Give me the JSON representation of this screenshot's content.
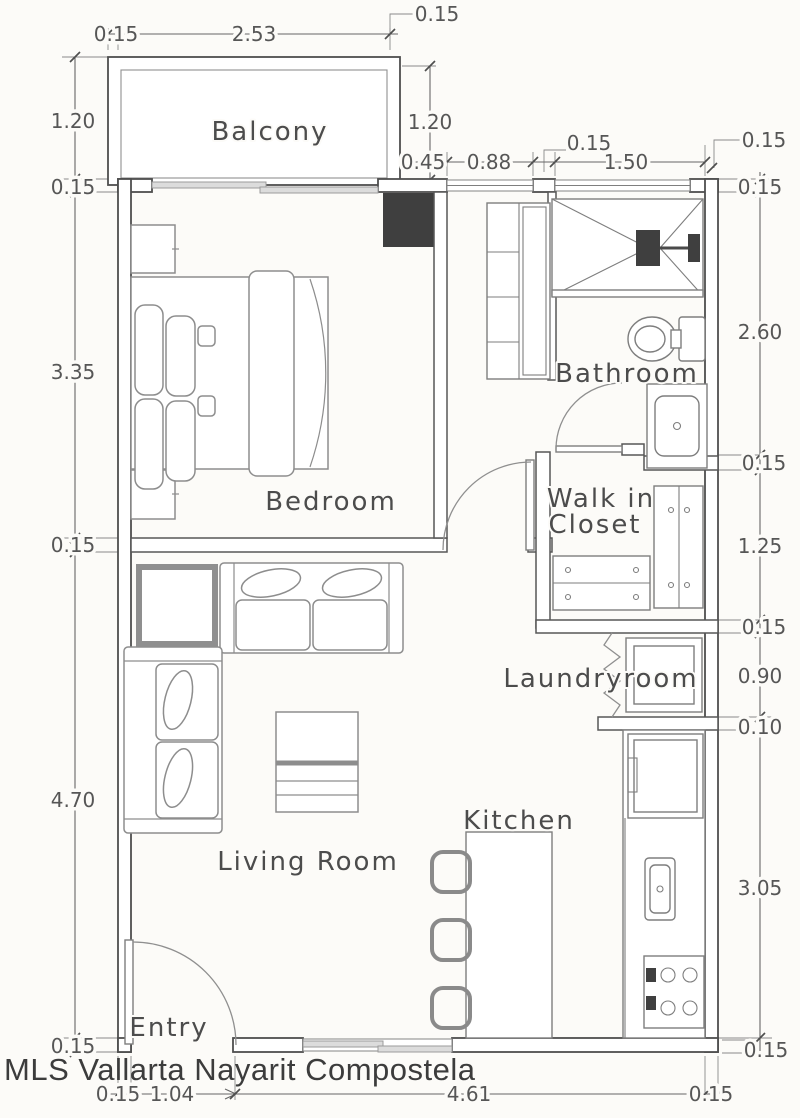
{
  "watermark": "MLS Vallarta Nayarit Compostela",
  "rooms": {
    "balcony": "Balcony",
    "bedroom": "Bedroom",
    "bathroom": "Bathroom",
    "walk_in_closet_line1": "Walk in",
    "walk_in_closet_line2": "Closet",
    "laundry": "Laundryroom",
    "living": "Living Room",
    "kitchen": "Kitchen",
    "entry": "Entry"
  },
  "dims": {
    "top_balcony_wall": "0.15",
    "top_balcony_width": "2.53",
    "top_leader": "0.15",
    "balcony_depth_left": "1.20",
    "balcony_depth_right": "1.20",
    "column_width": "0.45",
    "window_small": "0.88",
    "window_pier": "0.15",
    "window_large": "1.50",
    "right_wall_top": "0.15",
    "left_wall_top": "0.15",
    "bedroom_width": "3.35",
    "divider_wall": "0.15",
    "living_width": "4.70",
    "left_bottom_wall": "0.15",
    "right_top_wall": "0.15",
    "bathroom_height": "2.60",
    "bath_closet_wall": "0.15",
    "closet_height": "1.25",
    "closet_laundry_wall": "0.15",
    "laundry_height": "0.90",
    "laundry_thin_wall": "0.10",
    "kitchen_height": "3.05",
    "right_bottom_wall": "0.15",
    "entry_side_wall": "0.15",
    "entry_opening": "1.04",
    "bottom_span": "4.61",
    "bottom_right_wall": "0.15"
  }
}
